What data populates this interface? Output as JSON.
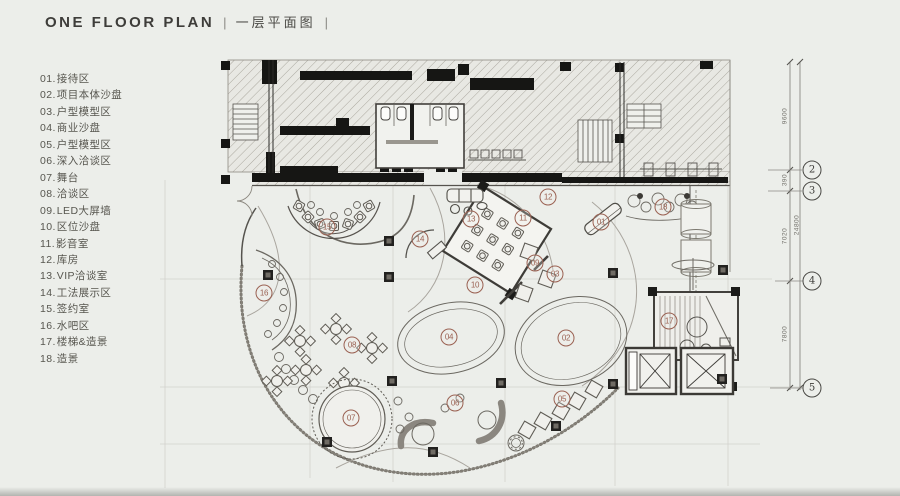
{
  "page": {
    "title_en": "ONE FLOOR PLAN",
    "title_sep_left": "|",
    "title_zh": "一层平面图",
    "title_sep_right": "|"
  },
  "colors": {
    "bg": "#eceeea",
    "accent": "#9a6152",
    "line-dark": "#3e3c38",
    "line-mid": "#6b6861",
    "text-main": "#3e3d3a",
    "text-legend": "#57564f",
    "text-dim": "#716f69"
  },
  "legend": {
    "items": [
      {
        "num": "01.",
        "label": "接待区"
      },
      {
        "num": "02.",
        "label": "项目本体沙盘"
      },
      {
        "num": "03.",
        "label": "户型模型区"
      },
      {
        "num": "04.",
        "label": "商业沙盘"
      },
      {
        "num": "05.",
        "label": "户型模型区"
      },
      {
        "num": "06.",
        "label": "深入洽谈区"
      },
      {
        "num": "07.",
        "label": "舞台"
      },
      {
        "num": "08.",
        "label": "洽谈区"
      },
      {
        "num": "09.",
        "label": "LED大屏墙"
      },
      {
        "num": "10.",
        "label": "区位沙盘"
      },
      {
        "num": "11.",
        "label": "影音室"
      },
      {
        "num": "12.",
        "label": "库房"
      },
      {
        "num": "13.",
        "label": "VIP洽谈室"
      },
      {
        "num": "14.",
        "label": "工法展示区"
      },
      {
        "num": "15.",
        "label": "签约室"
      },
      {
        "num": "16.",
        "label": "水吧区"
      },
      {
        "num": "17.",
        "label": "楼梯&造景"
      },
      {
        "num": "18.",
        "label": "造景"
      }
    ]
  },
  "plan": {
    "markers": [
      {
        "num": "01",
        "x": 601,
        "y": 222
      },
      {
        "num": "02",
        "x": 566,
        "y": 338
      },
      {
        "num": "03",
        "x": 555,
        "y": 274
      },
      {
        "num": "04",
        "x": 449,
        "y": 337
      },
      {
        "num": "05",
        "x": 562,
        "y": 399
      },
      {
        "num": "06",
        "x": 455,
        "y": 403
      },
      {
        "num": "07",
        "x": 351,
        "y": 418
      },
      {
        "num": "08",
        "x": 352,
        "y": 345
      },
      {
        "num": "09",
        "x": 535,
        "y": 263
      },
      {
        "num": "10",
        "x": 475,
        "y": 285
      },
      {
        "num": "11",
        "x": 523,
        "y": 218
      },
      {
        "num": "12",
        "x": 548,
        "y": 197
      },
      {
        "num": "13",
        "x": 471,
        "y": 219
      },
      {
        "num": "14",
        "x": 420,
        "y": 239
      },
      {
        "num": "15",
        "x": 327,
        "y": 227
      },
      {
        "num": "16",
        "x": 264,
        "y": 293
      },
      {
        "num": "17",
        "x": 669,
        "y": 321
      },
      {
        "num": "18",
        "x": 663,
        "y": 207
      }
    ],
    "grid_bubbles": [
      {
        "num": "2",
        "x": 812,
        "y": 170
      },
      {
        "num": "3",
        "x": 812,
        "y": 191
      },
      {
        "num": "4",
        "x": 812,
        "y": 281
      },
      {
        "num": "5",
        "x": 812,
        "y": 388
      }
    ],
    "dimensions": [
      {
        "text": "9600",
        "x": 785,
        "y": 116
      },
      {
        "text": "390",
        "x": 785,
        "y": 180
      },
      {
        "text": "24800",
        "x": 797,
        "y": 225
      },
      {
        "text": "7020",
        "x": 785,
        "y": 236
      },
      {
        "text": "7800",
        "x": 785,
        "y": 334
      }
    ]
  }
}
